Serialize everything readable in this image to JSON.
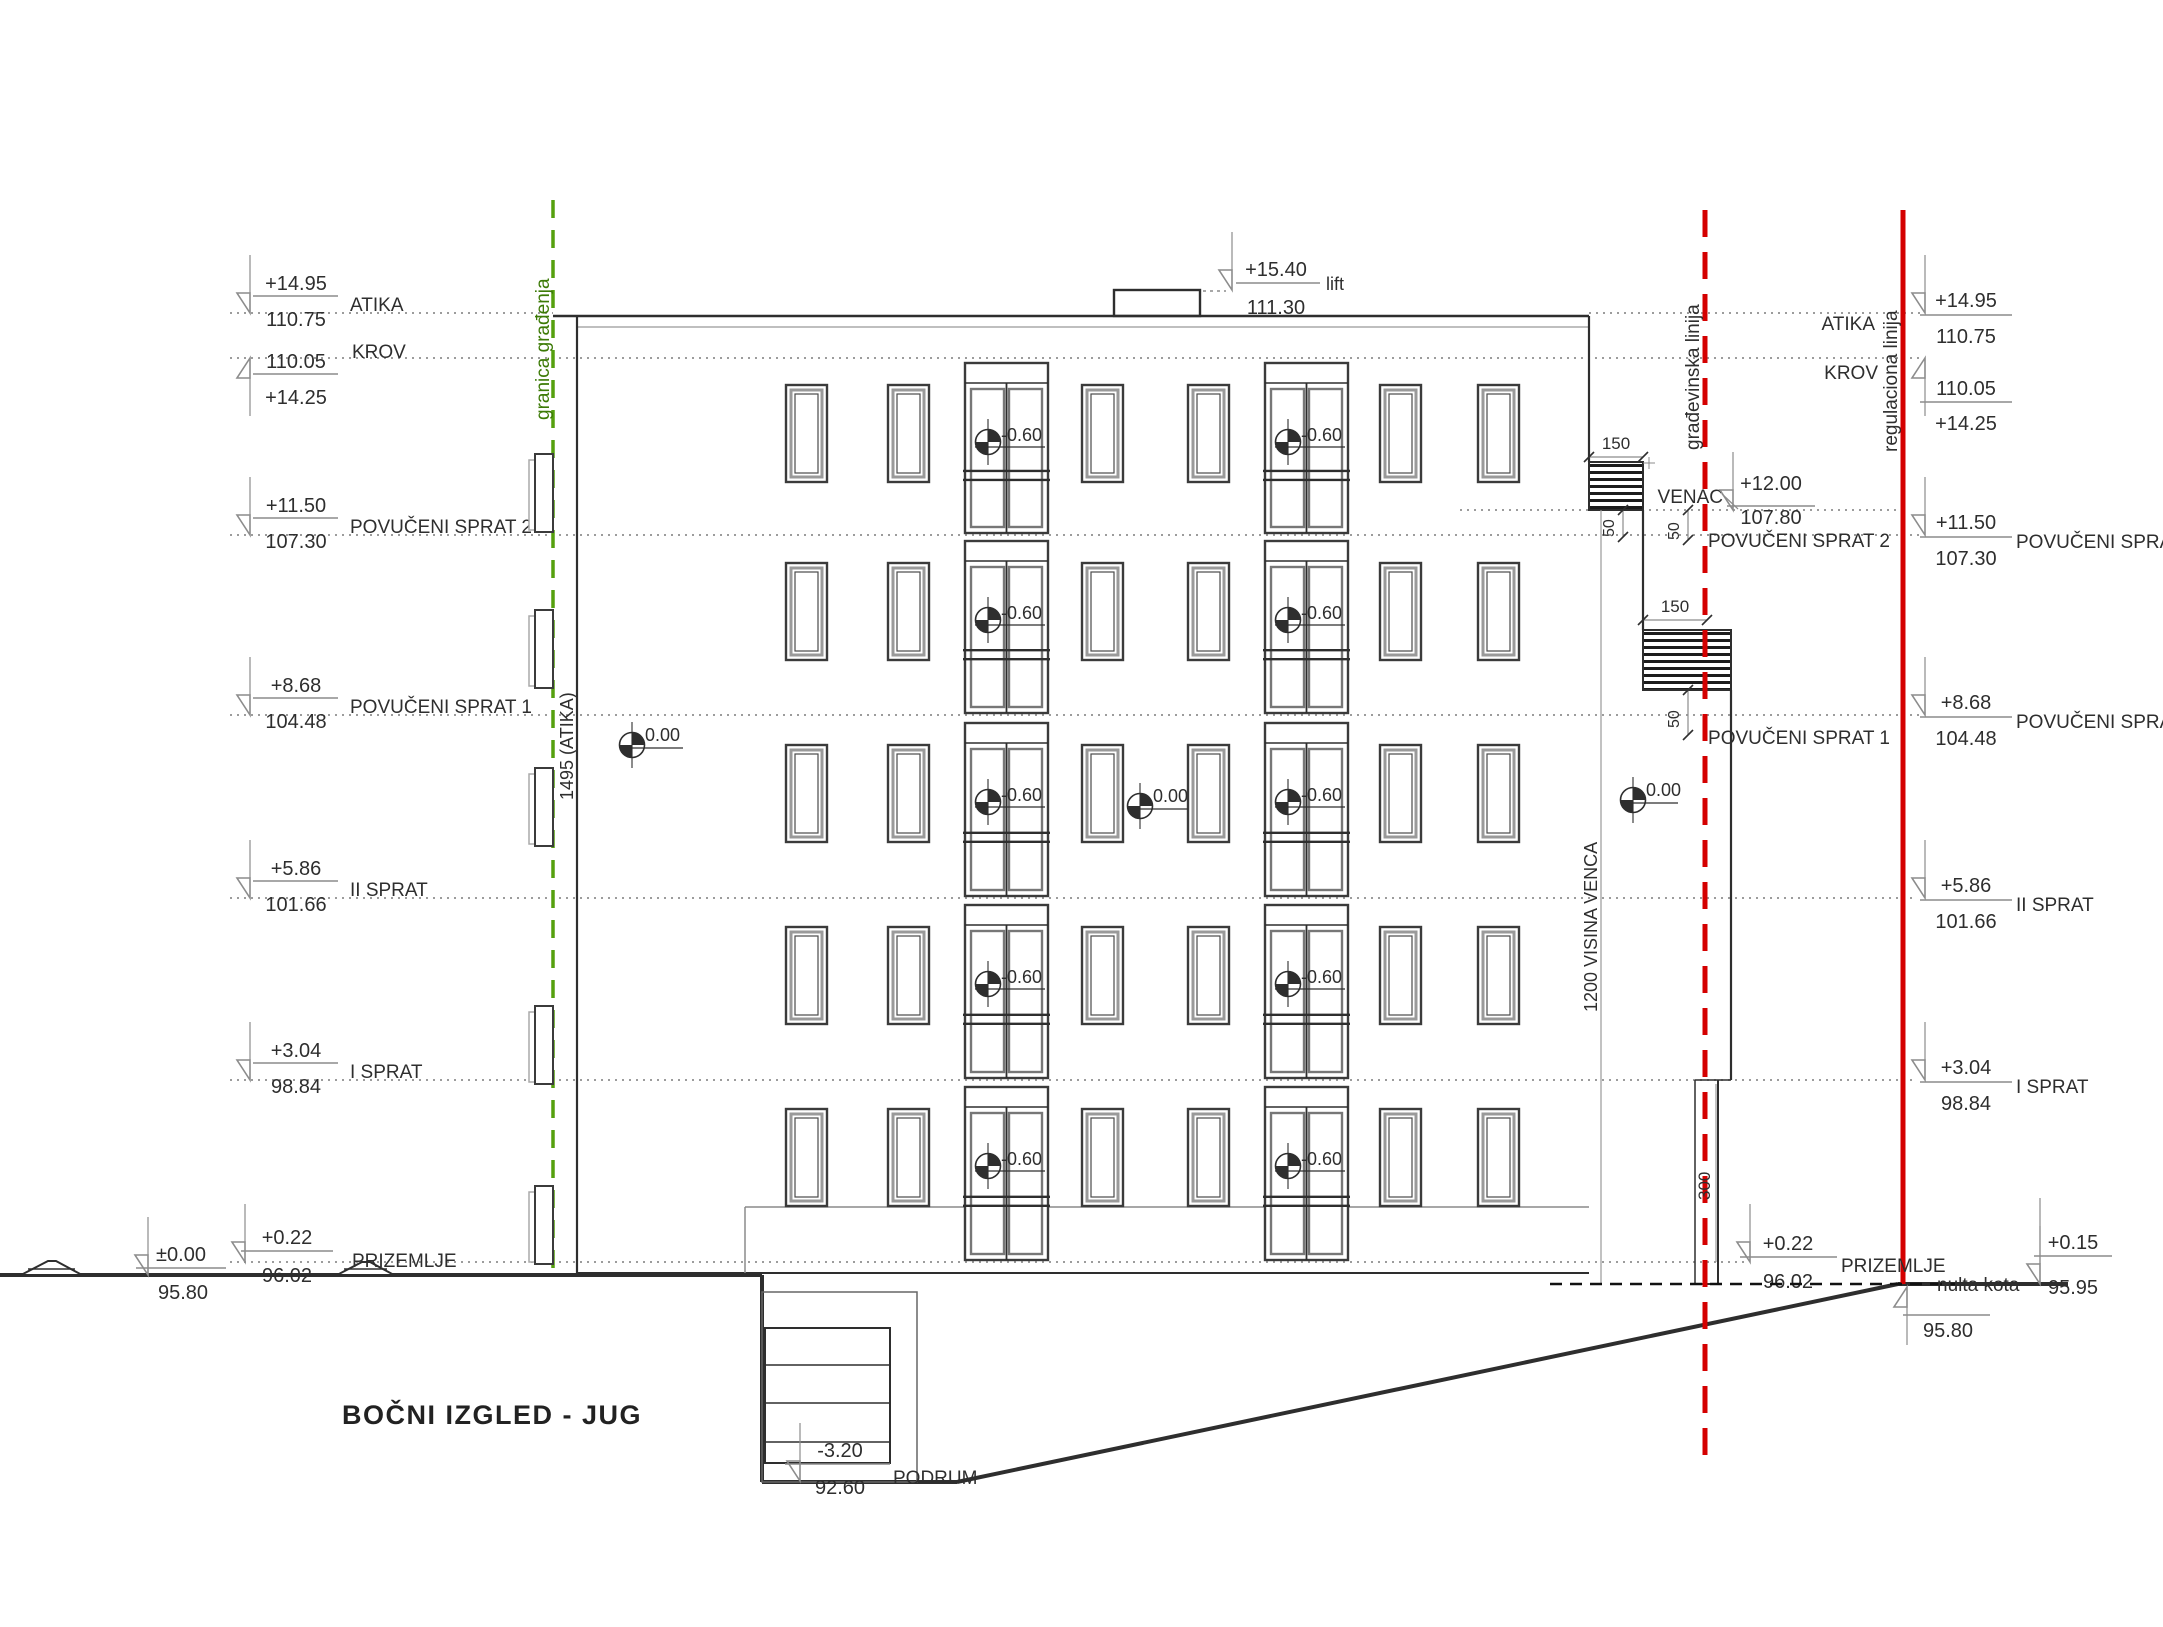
{
  "title": "BOČNI IZGLED - JUG",
  "colors": {
    "red": "#d40000",
    "green": "#55a00e",
    "green_dark": "#3c7a06",
    "ink": "#2e2e2e",
    "gray": "#8c8c8c"
  },
  "boundary_lines": {
    "granica_gradjenja": "granica građenja",
    "gradjevinska_linija": "građevinska linija",
    "regulaciona_linija": "regulaciona linija"
  },
  "dimensions": {
    "atika_total": "1495 (ATIKA)",
    "visina_venca": "1200 VISINA VENCA",
    "prizemlje_height": "300",
    "overhang_top": "150",
    "overhang_mid": "150",
    "offset_a": "50",
    "offset_b": "50",
    "offset_c": "50"
  },
  "levels_left": [
    {
      "id": "atika",
      "name": "ATIKA",
      "over": "+14.95",
      "under": "110.75"
    },
    {
      "id": "krov",
      "name": "KROV",
      "over": "110.05",
      "under": "+14.25"
    },
    {
      "id": "povuceni-sprat-2",
      "name": "POVUČENI SPRAT 2",
      "over": "+11.50",
      "under": "107.30"
    },
    {
      "id": "povuceni-sprat-1",
      "name": "POVUČENI SPRAT 1",
      "over": "+8.68",
      "under": "104.48"
    },
    {
      "id": "ii-sprat",
      "name": "II SPRAT",
      "over": "+5.86",
      "under": "101.66"
    },
    {
      "id": "i-sprat",
      "name": "I SPRAT",
      "over": "+3.04",
      "under": "98.84"
    },
    {
      "id": "teren",
      "name": "",
      "over": "±0.00",
      "under": "95.80"
    },
    {
      "id": "prizemlje",
      "name": "PRIZEMLJE",
      "over": "+0.22",
      "under": "96.02"
    }
  ],
  "levels_right": [
    {
      "id": "atika",
      "name": "ATIKA",
      "over": "+14.95",
      "under": "110.75"
    },
    {
      "id": "krov",
      "name": "KROV",
      "over": "110.05",
      "under": "+14.25"
    },
    {
      "id": "povuceni-sprat-2",
      "name": "POVUČENI SPRAT 2",
      "over": "+11.50",
      "under": "107.30"
    },
    {
      "id": "povuceni-sprat-1",
      "name": "POVUČENI SPRAT 1",
      "over": "+8.68",
      "under": "104.48"
    },
    {
      "id": "ii-sprat",
      "name": "II SPRAT",
      "over": "+5.86",
      "under": "101.66"
    },
    {
      "id": "i-sprat",
      "name": "I SPRAT",
      "over": "+3.04",
      "under": "98.84"
    }
  ],
  "venac": {
    "name": "VENAC",
    "over": "+12.00",
    "under": "107.80"
  },
  "prizemlje_right": {
    "name": "PRIZEMLJE",
    "over": "+0.22",
    "under": "96.02"
  },
  "teren_right": {
    "over": "+0.15",
    "under": "95.95"
  },
  "nulta_kota": {
    "name": "nulta kota",
    "value": "95.80"
  },
  "lift": {
    "name": "lift",
    "over": "+15.40",
    "under": "111.30"
  },
  "podrum": {
    "name": "PODRUM",
    "over": "-3.20",
    "under": "92.60"
  },
  "level_markers": {
    "door_threshold": "-0.60",
    "terrace_zero": "0.00"
  }
}
